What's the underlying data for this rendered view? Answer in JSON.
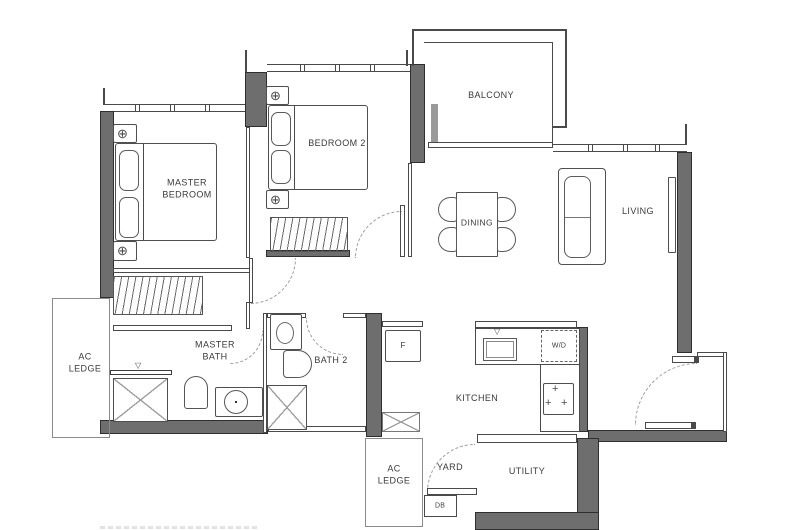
{
  "plan_title": "2-bedroom apartment floor plan",
  "rooms": {
    "master_bedroom": "MASTER BEDROOM",
    "bedroom2": "BEDROOM 2",
    "balcony": "BALCONY",
    "dining": "DINING",
    "living": "LIVING",
    "ac_ledge_left": "AC LEDGE",
    "master_bath": "MASTER BATH",
    "bath2": "BATH 2",
    "kitchen": "KITCHEN",
    "yard": "YARD",
    "utility": "UTILITY",
    "ac_ledge_bottom": "AC LEDGE",
    "db": "DB"
  },
  "fixtures": {
    "fridge": "F",
    "washer_dryer": "W/D"
  },
  "symbols": {
    "corner_unit": "⊕",
    "burner": "+",
    "tap": "▽"
  },
  "colors": {
    "wall_fill": "#6e6e6e",
    "line": "#4a4a4a",
    "text": "#3a3a3a",
    "background": "#ffffff"
  }
}
